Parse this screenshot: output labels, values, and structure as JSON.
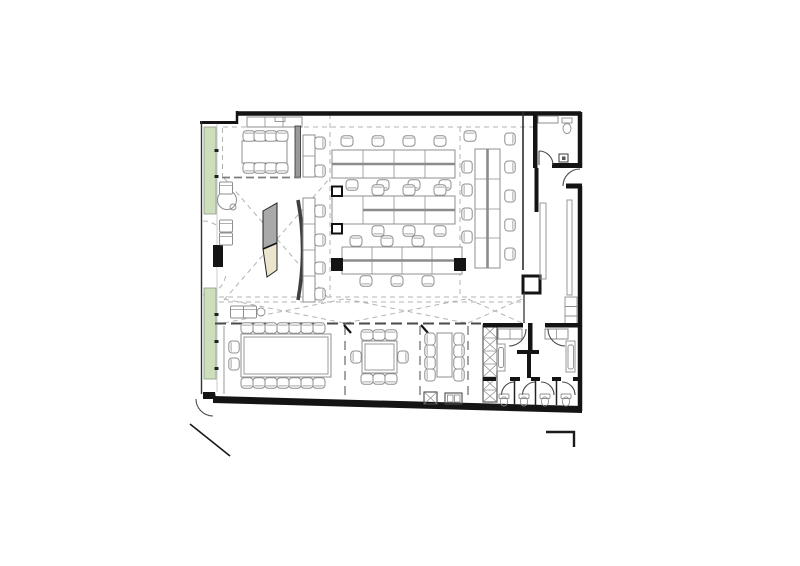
{
  "meta": {
    "drawing_type": "architectural-floor-plan",
    "content": "office floor plan, top view, black line work on white",
    "rooms": [
      "entrance",
      "reception-lounge",
      "meeting-room-top-left",
      "open-office",
      "corridor-right",
      "lobby-wc-top-right",
      "boardroom",
      "meeting-room-2",
      "meeting-room-3",
      "kitchen-column",
      "washroom-left",
      "washroom-right",
      "wc-stalls"
    ]
  },
  "colors": {
    "background": "#ffffff",
    "wall": "#141414",
    "furniture_line": "#8f8f8f",
    "desk_stripe": "#8c8c8c",
    "dash": "#b3b3b3",
    "planter": "#ccdebc",
    "wall_gray": "#9a9a9a",
    "reception_gray": "#a9a9a9",
    "reception_beige": "#ebe5cd"
  },
  "furniture": {
    "chairs": [
      [
        347,
        141,
        0
      ],
      [
        378,
        141,
        0
      ],
      [
        409,
        141,
        0
      ],
      [
        440,
        141,
        0
      ],
      [
        470,
        136,
        0
      ],
      [
        352,
        185,
        180
      ],
      [
        383,
        185,
        180
      ],
      [
        414,
        185,
        180
      ],
      [
        445,
        185,
        180
      ],
      [
        378,
        190,
        0
      ],
      [
        409,
        190,
        0
      ],
      [
        440,
        190,
        0
      ],
      [
        378,
        231,
        180
      ],
      [
        409,
        231,
        180
      ],
      [
        440,
        231,
        180
      ],
      [
        356,
        241,
        0
      ],
      [
        387,
        241,
        0
      ],
      [
        418,
        241,
        0
      ],
      [
        366,
        281,
        180
      ],
      [
        397,
        281,
        180
      ],
      [
        428,
        281,
        180
      ],
      [
        467,
        167,
        270
      ],
      [
        467,
        190,
        270
      ],
      [
        467,
        214,
        270
      ],
      [
        467,
        237,
        270
      ],
      [
        510,
        139,
        90
      ],
      [
        510,
        167,
        90
      ],
      [
        510,
        196,
        90
      ],
      [
        510,
        225,
        90
      ],
      [
        510,
        254,
        90
      ],
      [
        320,
        143,
        90
      ],
      [
        320,
        171,
        90
      ],
      [
        320,
        211,
        90
      ],
      [
        320,
        240,
        90
      ],
      [
        320,
        268,
        90
      ],
      [
        320,
        294,
        90
      ],
      [
        249,
        136,
        0
      ],
      [
        260,
        136,
        0
      ],
      [
        271,
        136,
        0
      ],
      [
        282,
        136,
        0
      ],
      [
        249,
        168,
        180
      ],
      [
        260,
        168,
        180
      ],
      [
        271,
        168,
        180
      ],
      [
        282,
        168,
        180
      ],
      [
        247,
        328,
        0
      ],
      [
        259,
        328,
        0
      ],
      [
        271,
        328,
        0
      ],
      [
        283,
        328,
        0
      ],
      [
        295,
        328,
        0
      ],
      [
        307,
        328,
        0
      ],
      [
        319,
        328,
        0
      ],
      [
        247,
        383,
        180
      ],
      [
        259,
        383,
        180
      ],
      [
        271,
        383,
        180
      ],
      [
        283,
        383,
        180
      ],
      [
        295,
        383,
        180
      ],
      [
        307,
        383,
        180
      ],
      [
        319,
        383,
        180
      ],
      [
        234,
        347,
        270
      ],
      [
        234,
        364,
        270
      ],
      [
        367,
        335,
        0
      ],
      [
        379,
        335,
        0
      ],
      [
        391,
        335,
        0
      ],
      [
        367,
        379,
        180
      ],
      [
        379,
        379,
        180
      ],
      [
        391,
        379,
        180
      ],
      [
        356,
        357,
        270
      ],
      [
        403,
        357,
        90
      ],
      [
        430,
        339,
        270
      ],
      [
        430,
        351,
        270
      ],
      [
        430,
        363,
        270
      ],
      [
        430,
        375,
        270
      ],
      [
        459,
        339,
        90
      ],
      [
        459,
        351,
        90
      ],
      [
        459,
        363,
        90
      ],
      [
        459,
        375,
        90
      ]
    ],
    "armchairs": [
      [
        226,
        188
      ],
      [
        226,
        226
      ],
      [
        226,
        239
      ],
      [
        237,
        312
      ],
      [
        250,
        312
      ]
    ]
  }
}
